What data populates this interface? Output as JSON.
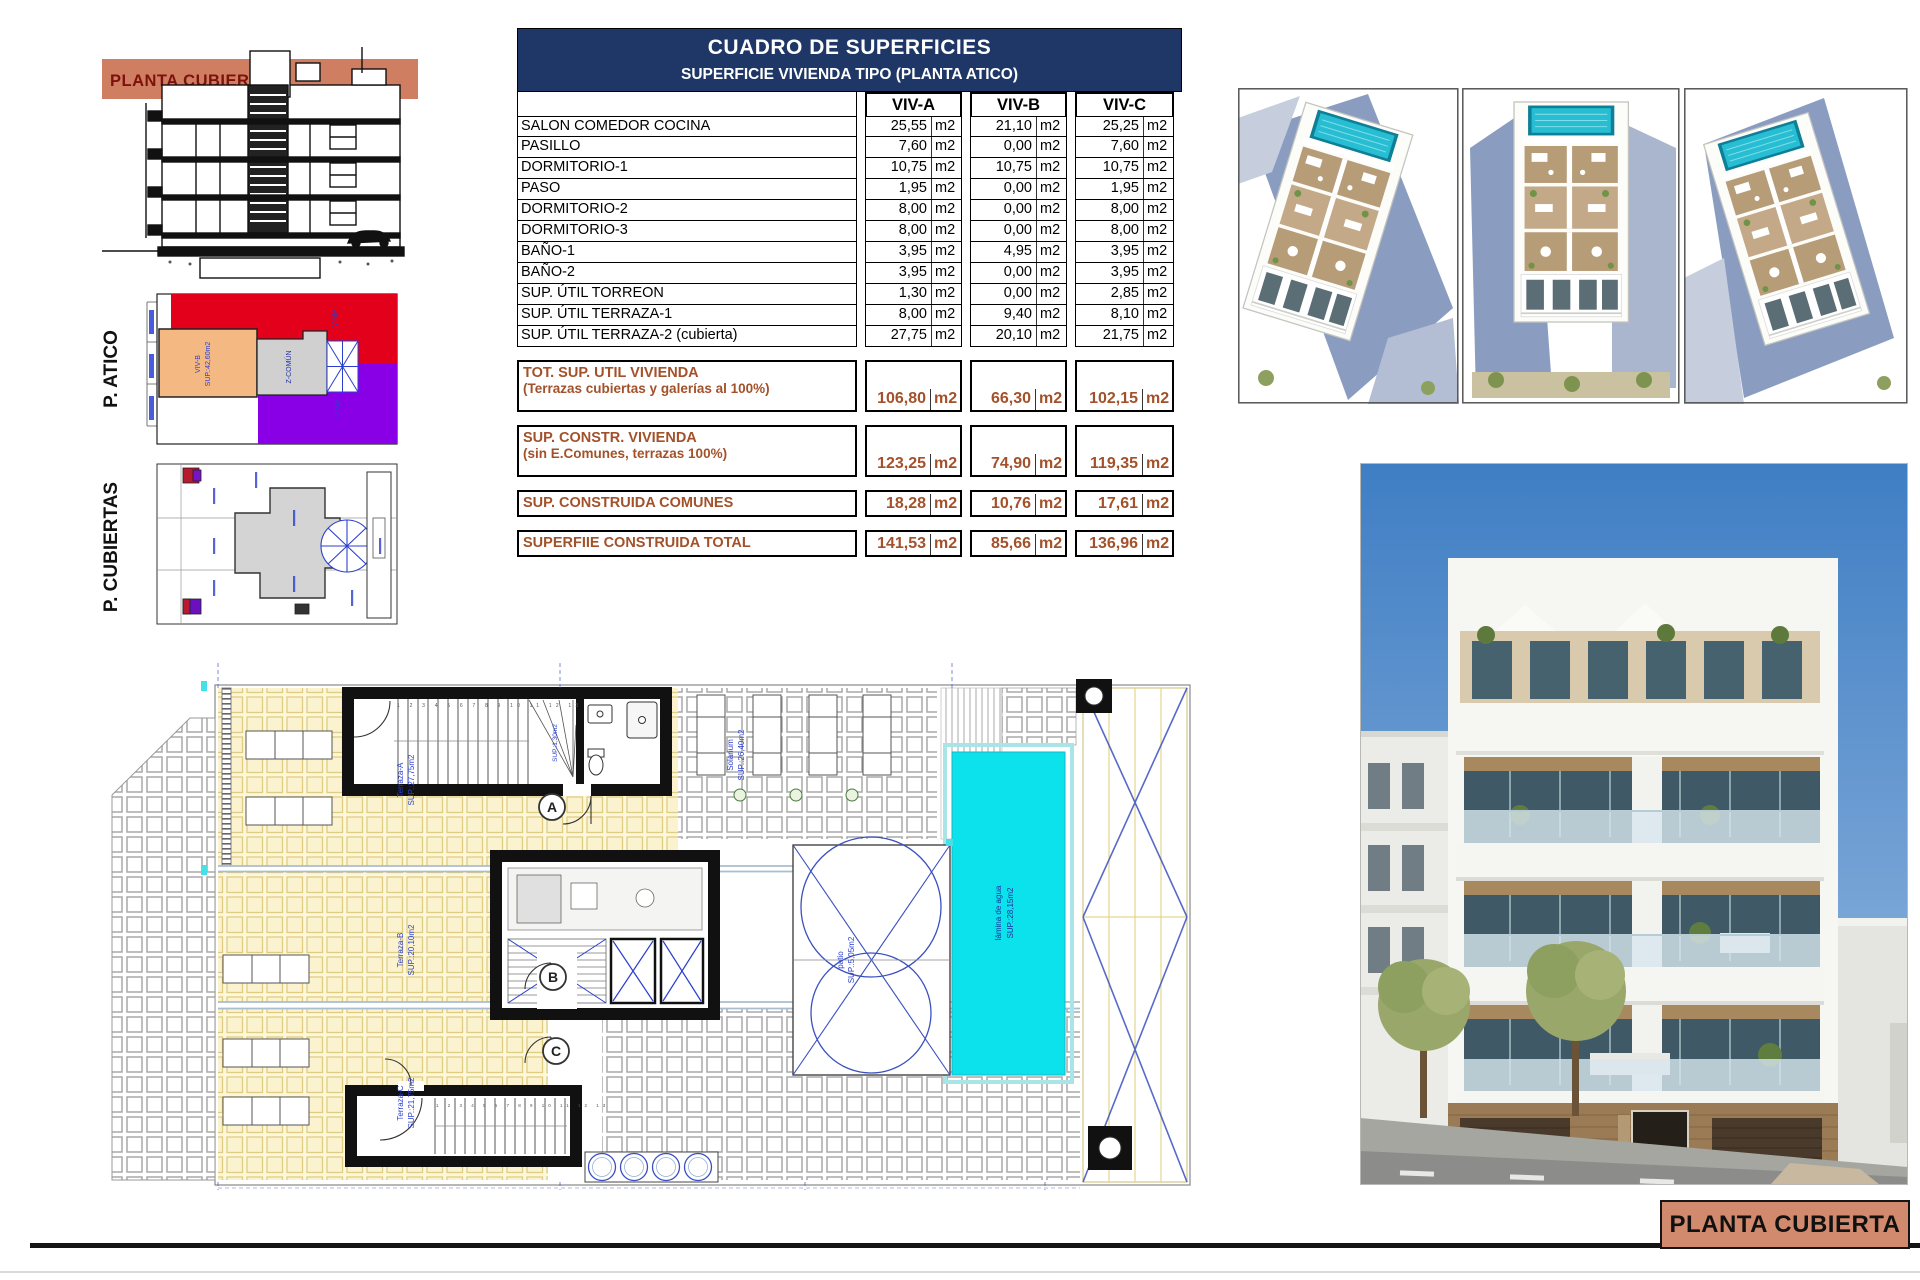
{
  "sheet": {
    "footer_label": "PLANTA CUBIERTA"
  },
  "colors": {
    "navy_header": "#1e3766",
    "salmon_band": "#cf7e62",
    "salmon_box": "#d28a6e",
    "summary_brown": "#a3512a",
    "pool_cyan": "#0be2ec",
    "tile_yellow": "#fdf7dc",
    "viv_a_red": "#e3001b",
    "viv_b_orange": "#f4b983",
    "viv_c_purple": "#8a00e6",
    "annotation_blue": "#2a3fd0"
  },
  "section_thumb": {
    "band_label": "PLANTA CUBIERTA"
  },
  "side_plans": {
    "atico_title": "P. ATICO",
    "cubiertas_title": "P. CUBIERTAS",
    "atico_labels": {
      "viv_a": "VIV-A",
      "viv_b": "VIV-B",
      "viv_b_sup": "SUP.:42,60m2",
      "viv_c": "VIV-C",
      "comun": "Z-COMÚN"
    }
  },
  "surfaces_table": {
    "title": "CUADRO DE SUPERFICIES",
    "subtitle": "SUPERFICIE VIVIENDA TIPO  (PLANTA ATICO)",
    "columns": [
      "VIV-A",
      "VIV-B",
      "VIV-C"
    ],
    "unit": "m2",
    "rows": [
      {
        "label": "SALON COMEDOR COCINA",
        "values": [
          "25,55",
          "21,10",
          "25,25"
        ]
      },
      {
        "label": "PASILLO",
        "values": [
          "7,60",
          "0,00",
          "7,60"
        ]
      },
      {
        "label": "DORMITORIO-1",
        "values": [
          "10,75",
          "10,75",
          "10,75"
        ]
      },
      {
        "label": "PASO",
        "values": [
          "1,95",
          "0,00",
          "1,95"
        ]
      },
      {
        "label": "DORMITORIO-2",
        "values": [
          "8,00",
          "0,00",
          "8,00"
        ]
      },
      {
        "label": "DORMITORIO-3",
        "values": [
          "8,00",
          "0,00",
          "8,00"
        ]
      },
      {
        "label": "BAÑO-1",
        "values": [
          "3,95",
          "4,95",
          "3,95"
        ]
      },
      {
        "label": "BAÑO-2",
        "values": [
          "3,95",
          "0,00",
          "3,95"
        ]
      },
      {
        "label": "SUP. ÚTIL TORREON",
        "values": [
          "1,30",
          "0,00",
          "2,85"
        ]
      },
      {
        "label": "SUP. ÚTIL TERRAZA-1",
        "values": [
          "8,00",
          "9,40",
          "8,10"
        ]
      },
      {
        "label": "SUP. ÚTIL TERRAZA-2 (cubierta)",
        "values": [
          "27,75",
          "20,10",
          "21,75"
        ]
      }
    ],
    "summary": [
      {
        "label": "TOT. SUP. UTIL VIVIENDA",
        "sublabel": "(Terrazas cubiertas y galerías al 100%)",
        "values": [
          "106,80",
          "66,30",
          "102,15"
        ],
        "tall": true
      },
      {
        "label": "SUP. CONSTR. VIVIENDA",
        "sublabel": "(sin E.Comunes, terrazas 100%)",
        "values": [
          "123,25",
          "74,90",
          "119,35"
        ],
        "tall": true
      },
      {
        "label": "SUP. CONSTRUIDA COMUNES",
        "sublabel": "",
        "values": [
          "18,28",
          "10,76",
          "17,61"
        ],
        "tall": false
      },
      {
        "label": "SUPERFIIE CONSTRUIDA TOTAL",
        "sublabel": "",
        "values": [
          "141,53",
          "85,66",
          "136,96"
        ],
        "tall": false
      }
    ]
  },
  "floor_plan": {
    "labels": {
      "terraza_a": "Terraza-A",
      "terraza_a_sup": "SUP.:27,75m2",
      "terraza_b": "Terraza-B",
      "terraza_b_sup": "SUP.:20,10m2",
      "terraza_c": "Terraza-C",
      "terraza_c_sup": "SUP.:21,75m2",
      "solarium": "Solarium",
      "solarium_sup": "SUP.:26,40m2",
      "patio": "patio",
      "patio_sup": "SUP.:5,05m2",
      "pool_line1": "lámina de agua",
      "pool_line2": "SUP.:28,15m2",
      "torreon_sup": "SUP.:1,30m2",
      "door_a": "A",
      "door_b": "B",
      "door_c": "C",
      "stair_numbers": "1 2 3 4 5 6 7 8 9 10 11 12 13"
    }
  }
}
